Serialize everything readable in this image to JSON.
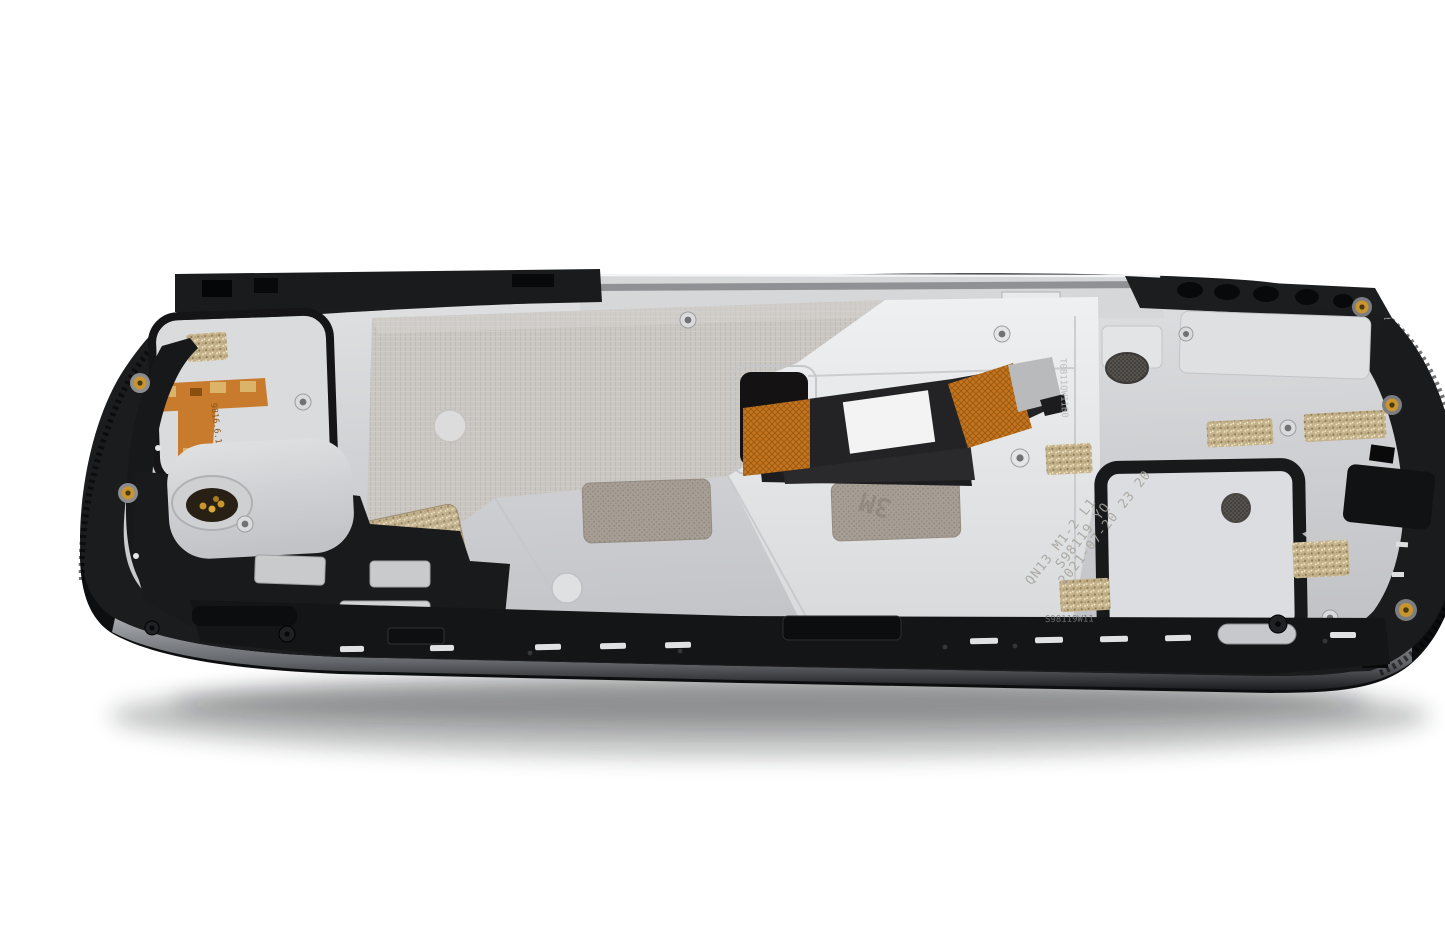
{
  "image": {
    "type": "product-photo",
    "subject": "Smartphone LCD display assembly with mid-frame, rear view, laid at an angle on white background",
    "background_color": "#ffffff"
  },
  "markings": {
    "etched_date": "2021-07-20 23 20",
    "etched_batch": "S98119 YQ",
    "etched_model": "QN13 M1-2 L1",
    "sensor_flex_code": "9816.6.10 P9020A",
    "connector_code": "T0811QW11B0",
    "rail_code": "S98119W11",
    "adhesive_brand": "3M"
  },
  "colors": {
    "background": "#ffffff",
    "frame_black": "#1b1c1e",
    "chassis_silver": "#d2d3d6",
    "bright_silver": "#e8eaec",
    "texture_panel": "#c9c5c1",
    "flex_orange": "#c4761f",
    "flex_black": "#232325",
    "flex_label_white": "#f2f3f2",
    "adhesive_gold": "#c4b28c",
    "adhesive_mesh_gray": "#a79f96",
    "contact_gold": "#c9952e"
  },
  "parts": [
    "outer-frame",
    "mid-plate",
    "lcd-laminate-panel",
    "lcd-flex-cable",
    "flex-white-label",
    "proximity-sensor-flex",
    "vibration-motor-contact",
    "speaker-mesh-adhesive",
    "graphite-pad",
    "screw-boss",
    "gasket-loop",
    "bottom-rail",
    "laser-etched-text"
  ]
}
